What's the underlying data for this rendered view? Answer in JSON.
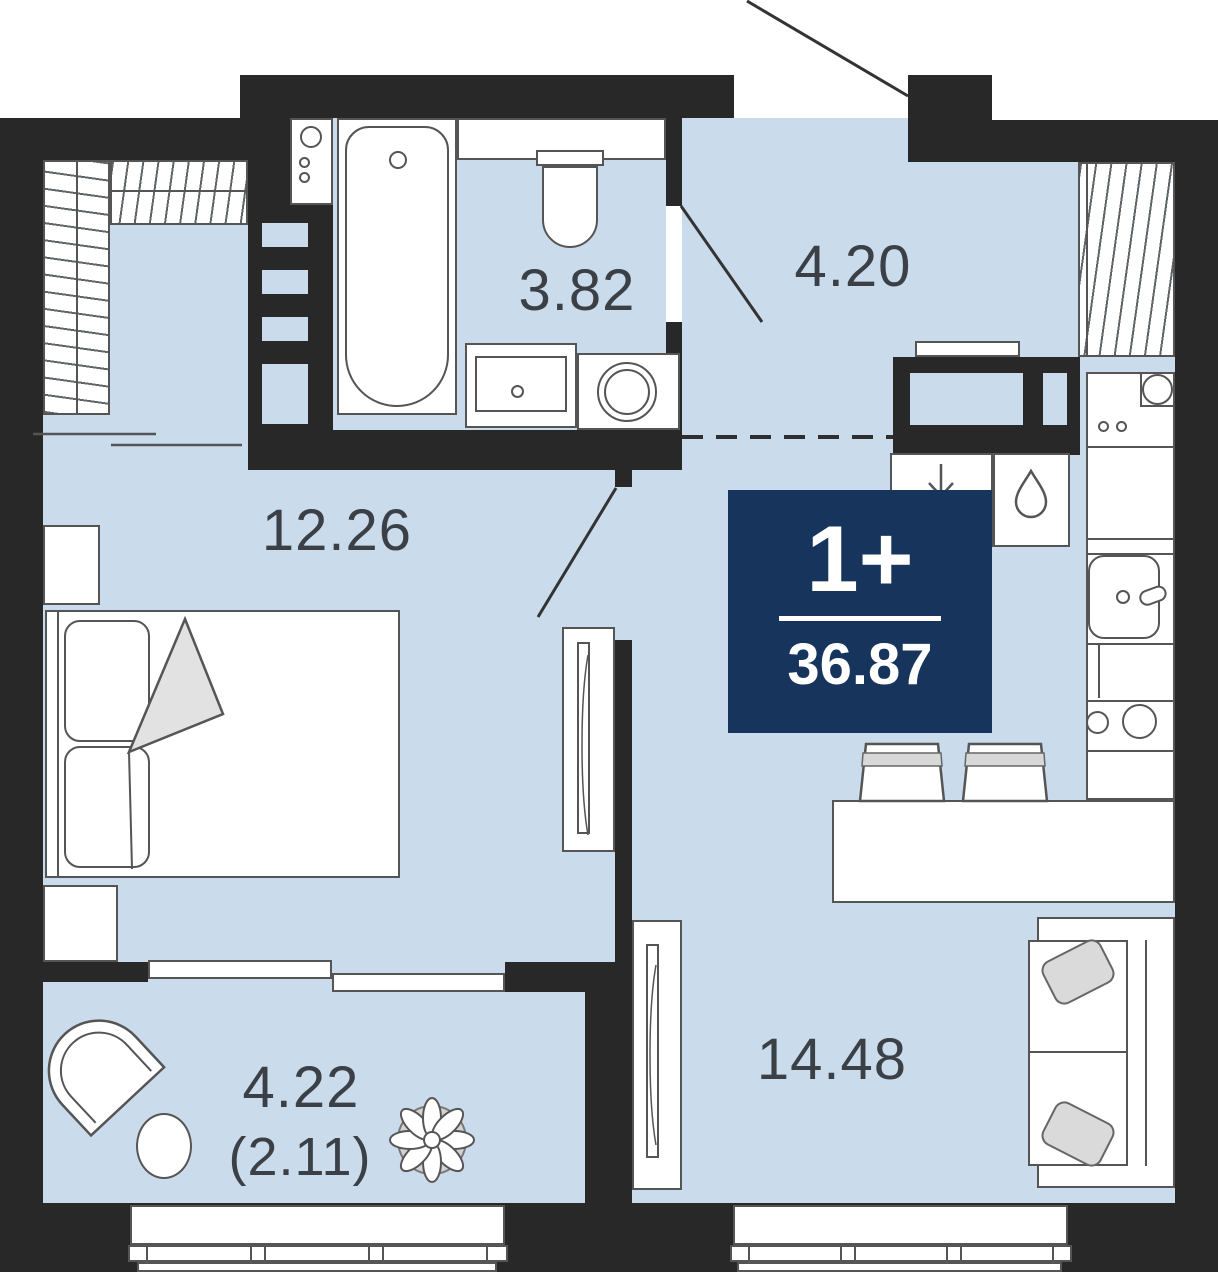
{
  "plan_type": "apartment-floor-plan",
  "badge": {
    "rooms_label": "1+",
    "total_area": "36.87"
  },
  "rooms": [
    {
      "name": "bathroom",
      "area": "3.82"
    },
    {
      "name": "hallway",
      "area": "4.20"
    },
    {
      "name": "bedroom",
      "area": "12.26"
    },
    {
      "name": "kitchen-living-room",
      "area": "14.48"
    },
    {
      "name": "balcony",
      "area": "4.22",
      "area_reduced": "(2.11)"
    }
  ],
  "icons": {
    "water-drop-icon": "teardrop shape (cold water riser)",
    "vent-arrow-icon": "down arrow (ventilation)",
    "flower-icon": "plant on balcony"
  },
  "colors": {
    "wall": "#282828",
    "floor": "#cadbec",
    "badge": "#16345c",
    "outline": "#555555",
    "label": "#3b4046"
  }
}
